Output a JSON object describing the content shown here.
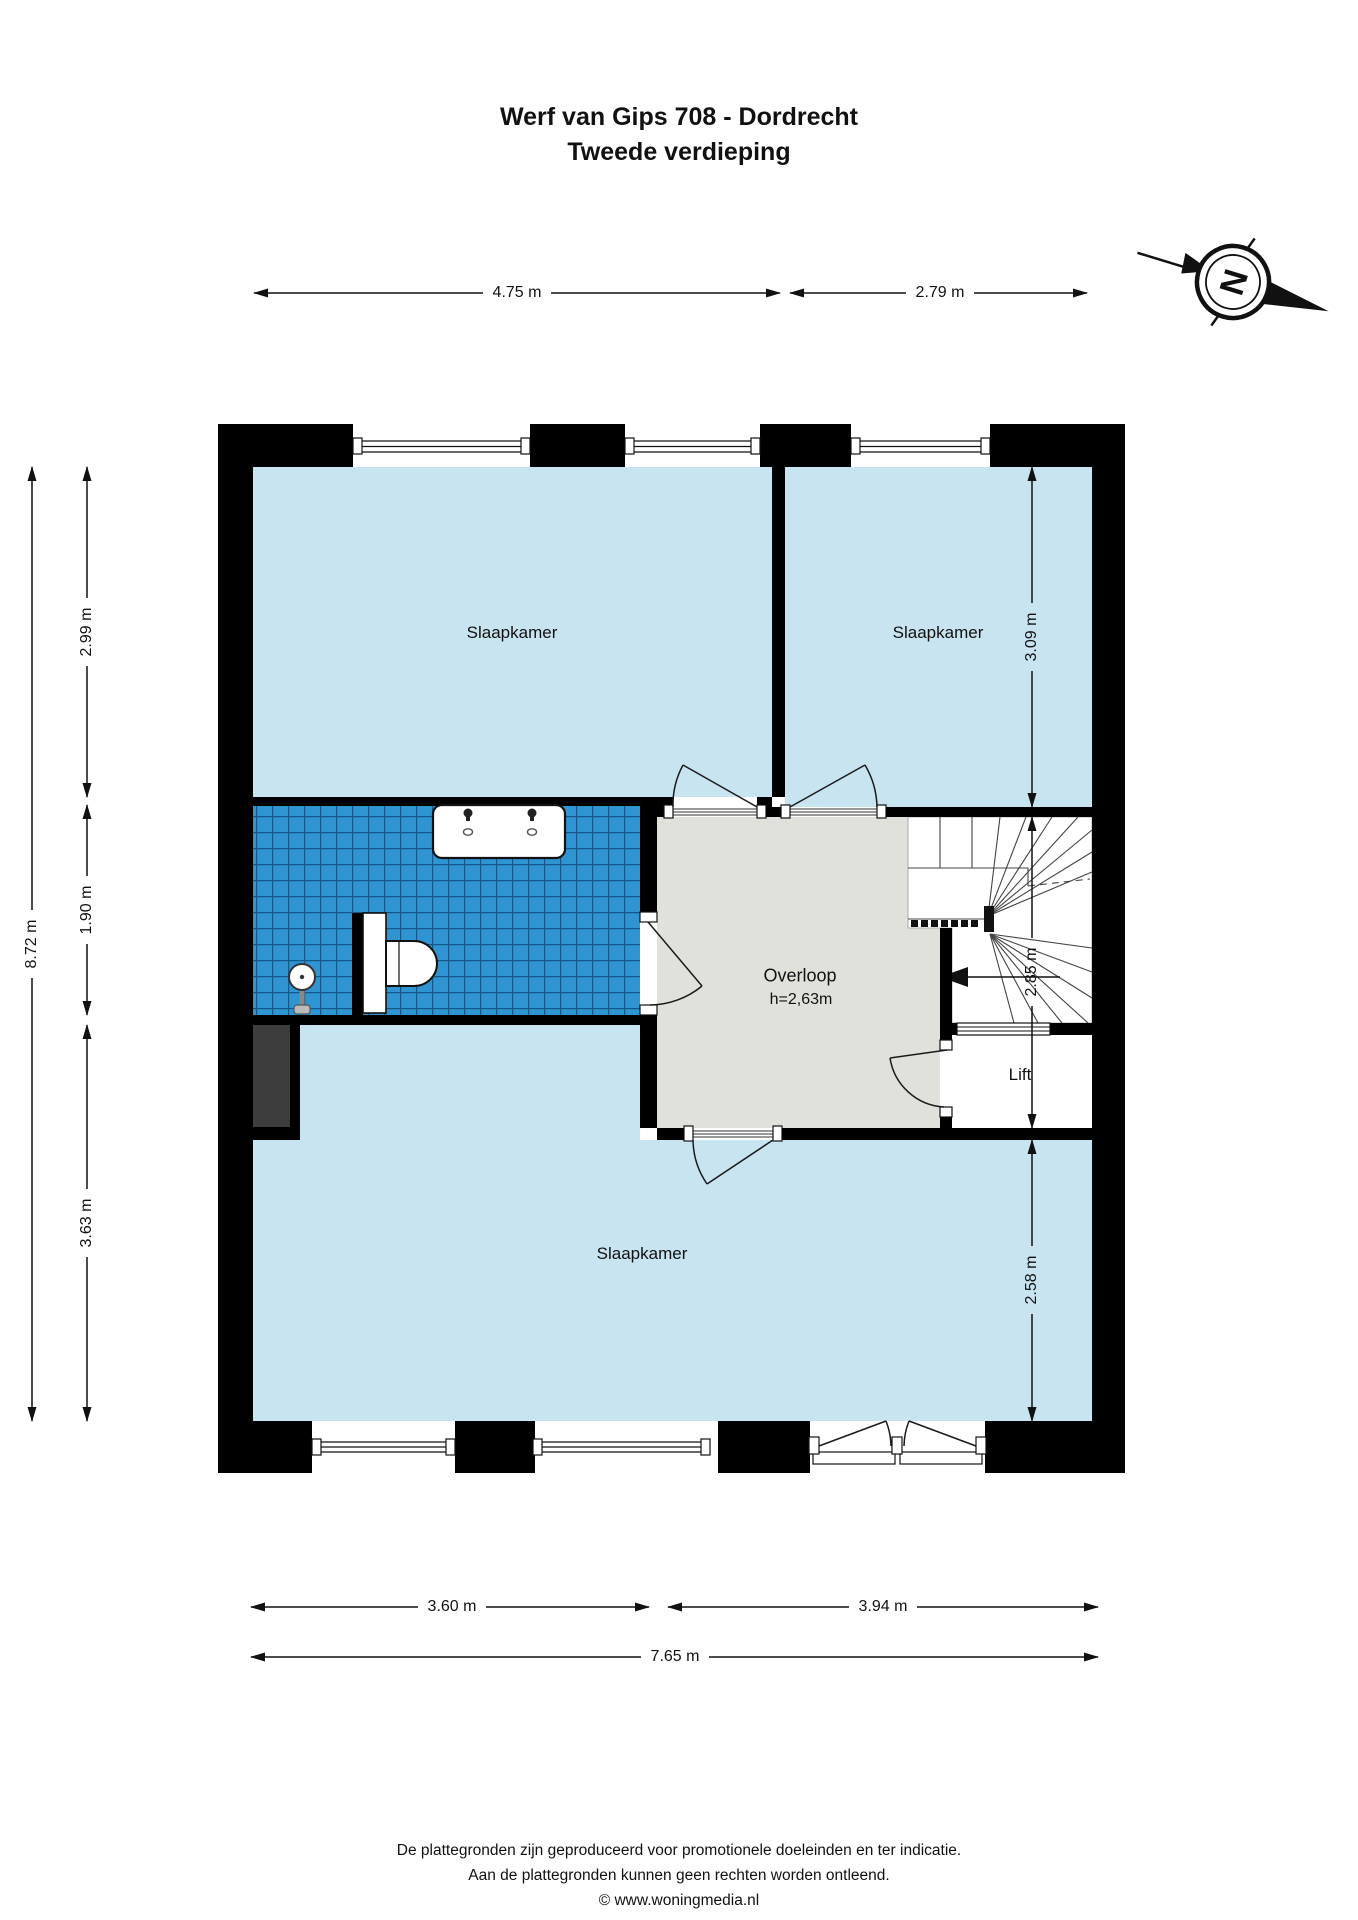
{
  "title": {
    "line1": "Werf van Gips 708 - Dordrecht",
    "line2": "Tweede verdieping"
  },
  "compass": {
    "north_label": "N"
  },
  "rooms": {
    "bedroom_top_left": "Slaapkamer",
    "bedroom_top_right": "Slaapkamer",
    "bedroom_bottom": "Slaapkamer",
    "hallway": "Overloop",
    "hallway_ceiling_height": "h=2,63m",
    "lift": "Lift"
  },
  "dimensions": {
    "top_left_width": "4.75 m",
    "top_right_width": "2.79 m",
    "left_total_height": "8.72 m",
    "left_bedroom_height": "2.99 m",
    "left_bathroom_height": "1.90 m",
    "left_bottom_height": "3.63 m",
    "right_bedroom_height": "3.09 m",
    "right_hall_height": "2.85 m",
    "right_bottom_height": "2.58 m",
    "bottom_left_width": "3.60 m",
    "bottom_right_width": "3.94 m",
    "bottom_total_width": "7.65 m"
  },
  "footer": {
    "line1": "De plattegronden zijn geproduceerd voor promotionele doeleinden en ter indicatie.",
    "line2": "Aan de plattegronden kunnen geen rechten worden ontleend.",
    "line3": "© www.woningmedia.nl"
  },
  "colors": {
    "wall": "#000000",
    "room_fill": "#c8e4f1",
    "tile_fill": "#2e95d2",
    "tile_line": "#12588a",
    "hall_fill": "#e1e1dc",
    "shaft_fill": "#3d3d3d",
    "line": "#1a1a1a"
  }
}
